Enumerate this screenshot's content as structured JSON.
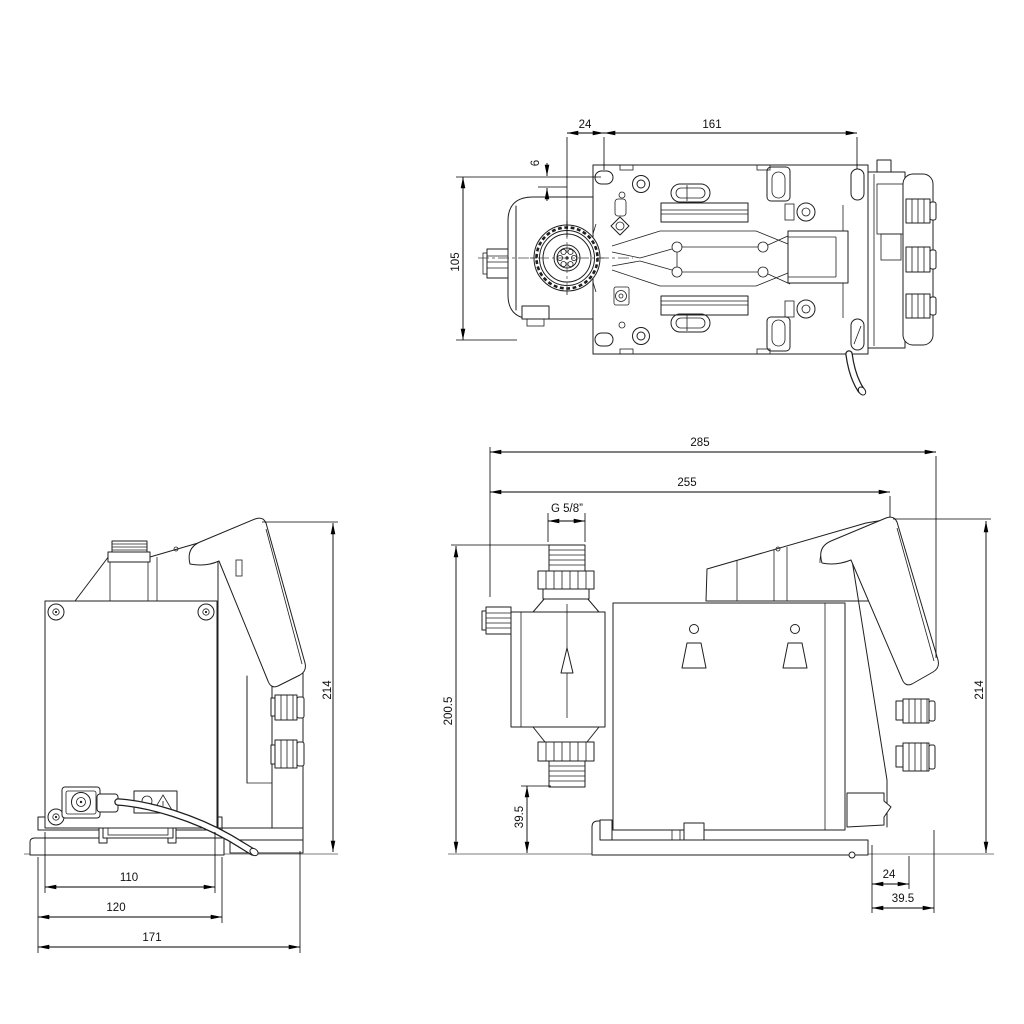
{
  "drawing": {
    "type": "technical-dimensional-drawing",
    "subject": "dosing-pump",
    "units": "mm",
    "colors": {
      "line": "#1f1f1f",
      "dimension": "#000000",
      "ground": "#a8a8a8",
      "background": "#ffffff"
    },
    "views": {
      "top": {
        "name": "top view",
        "dims": {
          "offset_24": "24",
          "length_161": "161",
          "offset_6": "6",
          "width_105": "105"
        }
      },
      "left": {
        "name": "left side view",
        "dims": {
          "width_110": "110",
          "width_120": "120",
          "depth_171": "171",
          "height_214": "214"
        }
      },
      "right": {
        "name": "right side view",
        "dims": {
          "total_285": "285",
          "width_255": "255",
          "thread": "G 5/8”",
          "height_200_5": "200.5",
          "inlet_39_5": "39.5",
          "height_214": "214",
          "offset_24": "24",
          "offset_39_5": "39.5"
        }
      }
    }
  }
}
